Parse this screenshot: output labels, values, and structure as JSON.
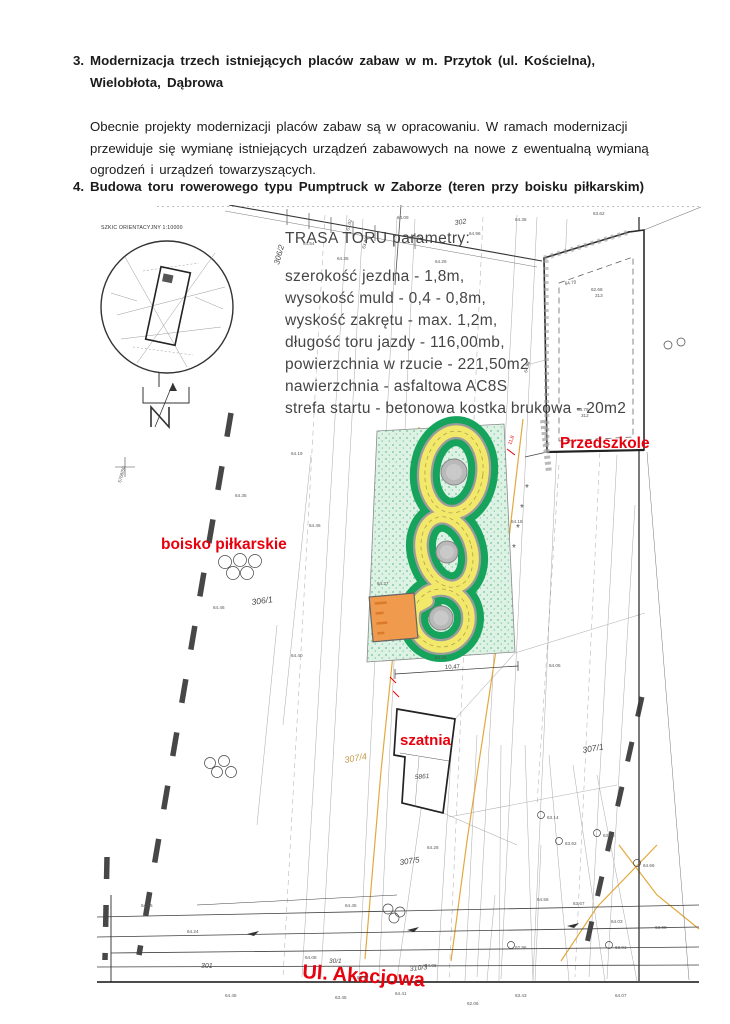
{
  "doc": {
    "item3_number": "3.",
    "item3_line1": "Modernizacja trzech istniejących placów zabaw w m. Przytok (ul. Kościelna),",
    "item3_line2": "Wielobłota, Dąbrowa",
    "para_line1": "Obecnie projekty modernizacji placów zabaw są w opracowaniu. W ramach modernizacji",
    "para_line2": "przewiduje się wymianę istniejących urządzeń zabawowych na nowe z ewentualną wymianą",
    "para_line3": "ogrodzeń i urządzeń towarzyszących.",
    "item4_number": "4.",
    "item4_title": "Budowa toru rowerowego typu Pumptruck w Zaborze (teren przy boisku piłkarskim)"
  },
  "map": {
    "inset_title": "SZKIC ORIENTACYJNY 1:10000",
    "north_label": "N",
    "params_title": "TRASA TORU parametry:",
    "params": [
      "szerokość jezdna - 1,8m,",
      "wysokość muld - 0,4 - 0,8m,",
      "wyskość zakrętu - max. 1,2m,",
      "długość toru jazdy - 116,00mb,",
      "powierzchnia w rzucie - 221,50m2",
      "nawierzchnia - asfaltowa AC8S",
      "strefa startu - betonowa kostka brukowa - 20m2"
    ],
    "labels": {
      "przedszkole": "Przedszkole",
      "boisko": "boisko piłkarskie",
      "szatnia": "szatnia",
      "ulica": "Ul. Akacjowa"
    },
    "plots": {
      "p306_2": "306/2",
      "p302": "302",
      "p306_1": "306/1",
      "p307_4": "307/4",
      "p307_1": "307/1",
      "p307_5": "307/5",
      "p310_3": "310/3",
      "p301": "301",
      "p30_1": "30/1",
      "p5861": "5861"
    },
    "dim_label": "10,47",
    "red_dim": "11,8",
    "colors": {
      "track_yellow": "#f2e96b",
      "track_edge_gray": "#9c9c9c",
      "green_dark": "#16a35c",
      "green_light": "#ddf2e5",
      "start_pad_orange": "#f09a4e",
      "label_red": "#e8000d",
      "utility_orange": "#e2a93e",
      "plot_tan": "#c49a45"
    },
    "elevations": [
      {
        "t": "63.02",
        "x": 252,
        "y": 26,
        "r": -75
      },
      {
        "t": "63.03",
        "x": 268,
        "y": 44,
        "r": -75
      },
      {
        "t": "64.09",
        "x": 300,
        "y": 14,
        "r": 0
      },
      {
        "t": "64.30",
        "x": 312,
        "y": 34,
        "r": 0
      },
      {
        "t": "64.35",
        "x": 240,
        "y": 55,
        "r": 0
      },
      {
        "t": "64.54",
        "x": 206,
        "y": 40,
        "r": 0
      },
      {
        "t": "64.26",
        "x": 338,
        "y": 58,
        "r": 0
      },
      {
        "t": "64.96",
        "x": 372,
        "y": 30,
        "r": 0
      },
      {
        "t": "64.36",
        "x": 418,
        "y": 16,
        "r": 0
      },
      {
        "t": "63.62",
        "x": 496,
        "y": 10,
        "r": 0
      },
      {
        "t": "64.70",
        "x": 468,
        "y": 80,
        "r": -8
      },
      {
        "t": "62.68",
        "x": 494,
        "y": 86,
        "r": 0
      },
      {
        "t": "313",
        "x": 498,
        "y": 92,
        "r": 0
      },
      {
        "t": "63.78",
        "x": 480,
        "y": 206,
        "r": 0
      },
      {
        "t": "312",
        "x": 484,
        "y": 212,
        "r": 0
      },
      {
        "t": "64.98",
        "x": 430,
        "y": 168,
        "r": -75
      },
      {
        "t": "5768/50",
        "x": 24,
        "y": 278,
        "r": -75
      },
      {
        "t": "64.35",
        "x": 138,
        "y": 292,
        "r": 0
      },
      {
        "t": "64.19",
        "x": 194,
        "y": 250,
        "r": 0
      },
      {
        "t": "64.45",
        "x": 212,
        "y": 322,
        "r": 0
      },
      {
        "t": "64.46",
        "x": 116,
        "y": 404,
        "r": 0
      },
      {
        "t": "64.40",
        "x": 194,
        "y": 452,
        "r": 0
      },
      {
        "t": "64.27",
        "x": 280,
        "y": 380,
        "r": 0
      },
      {
        "t": "64.25",
        "x": 338,
        "y": 454,
        "r": 0
      },
      {
        "t": "64.18",
        "x": 414,
        "y": 318,
        "r": 0
      },
      {
        "t": "64.05",
        "x": 452,
        "y": 462,
        "r": 0
      },
      {
        "t": "64.28",
        "x": 330,
        "y": 644,
        "r": 0
      },
      {
        "t": "64.45",
        "x": 248,
        "y": 702,
        "r": 0
      },
      {
        "t": "63.14",
        "x": 450,
        "y": 614,
        "r": 0
      },
      {
        "t": "63.62",
        "x": 468,
        "y": 640,
        "r": 0
      },
      {
        "t": "63.28",
        "x": 506,
        "y": 632,
        "r": 0
      },
      {
        "t": "64.66",
        "x": 546,
        "y": 662,
        "r": 0
      },
      {
        "t": "64.24",
        "x": 90,
        "y": 728,
        "r": 0
      },
      {
        "t": "64.55",
        "x": 44,
        "y": 702,
        "r": 0
      },
      {
        "t": "64.08",
        "x": 208,
        "y": 754,
        "r": 0
      },
      {
        "t": "63.97",
        "x": 260,
        "y": 774,
        "r": 0
      },
      {
        "t": "64.06",
        "x": 328,
        "y": 762,
        "r": 0
      },
      {
        "t": "62.96",
        "x": 418,
        "y": 744,
        "r": 0
      },
      {
        "t": "64.03",
        "x": 514,
        "y": 718,
        "r": 0
      },
      {
        "t": "63.91",
        "x": 518,
        "y": 744,
        "r": 0
      },
      {
        "t": "63.88",
        "x": 558,
        "y": 724,
        "r": 0
      },
      {
        "t": "63.67",
        "x": 476,
        "y": 700,
        "r": 0
      },
      {
        "t": "64.56",
        "x": 440,
        "y": 696,
        "r": 0
      },
      {
        "t": "64.45",
        "x": 128,
        "y": 792,
        "r": 0
      },
      {
        "t": "63.45",
        "x": 238,
        "y": 794,
        "r": 0
      },
      {
        "t": "64.41",
        "x": 298,
        "y": 790,
        "r": 0
      },
      {
        "t": "63.43",
        "x": 418,
        "y": 792,
        "r": 0
      },
      {
        "t": "64.07",
        "x": 518,
        "y": 792,
        "r": 0
      },
      {
        "t": "62.06",
        "x": 370,
        "y": 800,
        "r": 0
      }
    ]
  }
}
